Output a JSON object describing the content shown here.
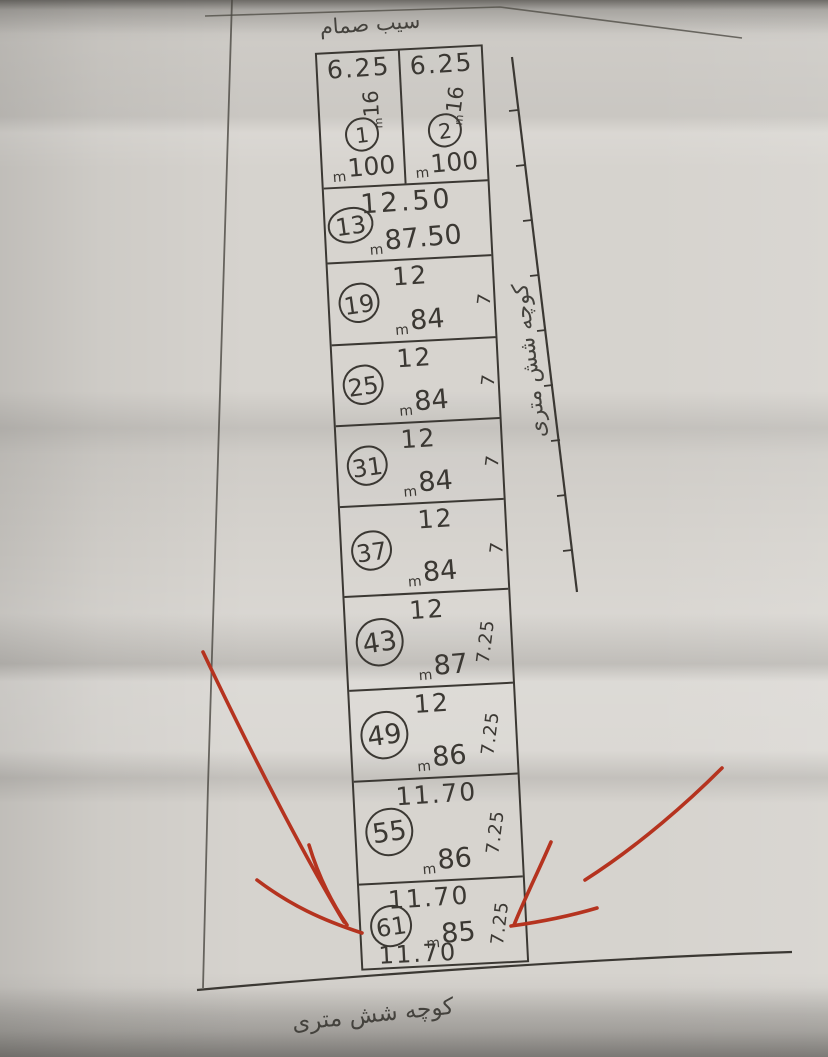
{
  "labels": {
    "top_note": "سیب صمام",
    "right_street": "کوچه شش متری",
    "bottom_street": "کوچه شش متری",
    "area_unit": "m"
  },
  "colors": {
    "ink": "#3b3833",
    "red_marker": "#b5331f",
    "paper": "#d6d3ce"
  },
  "plots": [
    {
      "number": "1",
      "top": "6.25",
      "side": "16",
      "area": "100"
    },
    {
      "number": "2",
      "top": "6.25",
      "side": "16",
      "area": "100"
    },
    {
      "number": "13",
      "top": "12.50",
      "area": "87.50"
    },
    {
      "number": "19",
      "top": "12",
      "side": "7",
      "area": "84"
    },
    {
      "number": "25",
      "top": "12",
      "side": "7",
      "area": "84"
    },
    {
      "number": "31",
      "top": "12",
      "side": "7",
      "area": "84"
    },
    {
      "number": "37",
      "top": "12",
      "side": "7",
      "area": "84"
    },
    {
      "number": "43",
      "top": "12",
      "side": "7.25",
      "area": "87"
    },
    {
      "number": "49",
      "top": "12",
      "side": "7.25",
      "area": "86"
    },
    {
      "number": "55",
      "top": "11.70",
      "side": "7.25",
      "area": "86"
    },
    {
      "number": "61",
      "top": "11.70",
      "side": "7.25",
      "area": "85",
      "bottom": "11.70"
    }
  ]
}
